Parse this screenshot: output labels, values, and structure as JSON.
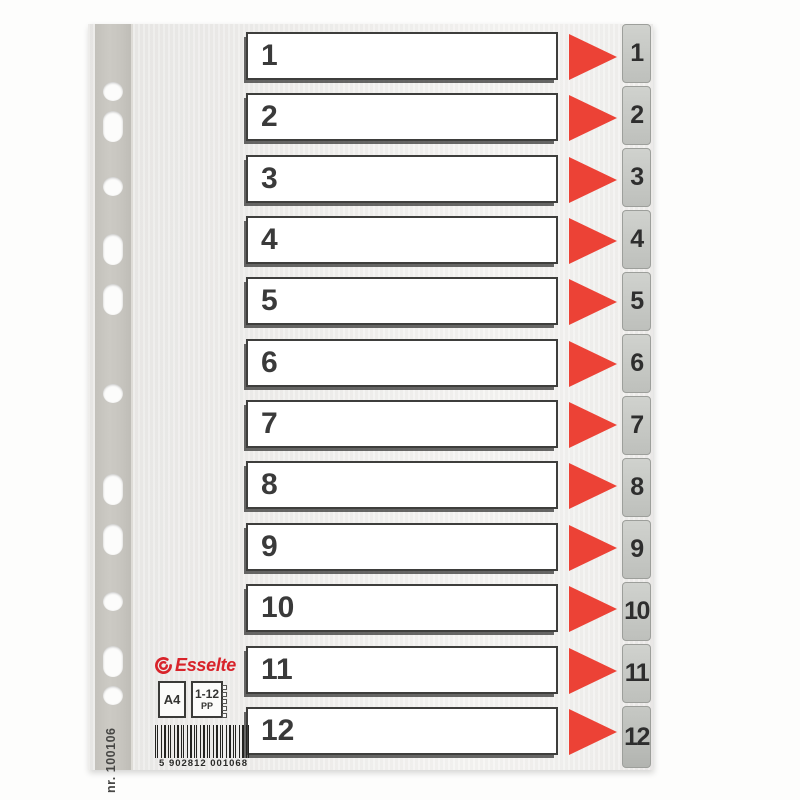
{
  "product": {
    "brand": "Esselte",
    "format": "A4",
    "index_range": "1-12",
    "material": "PP",
    "item_number": "nr. 100106",
    "barcode_digits": "5 902812 001068"
  },
  "rows": [
    {
      "label": "1"
    },
    {
      "label": "2"
    },
    {
      "label": "3"
    },
    {
      "label": "4"
    },
    {
      "label": "5"
    },
    {
      "label": "6"
    },
    {
      "label": "7"
    },
    {
      "label": "8"
    },
    {
      "label": "9"
    },
    {
      "label": "10"
    },
    {
      "label": "11"
    },
    {
      "label": "12"
    }
  ],
  "tabs": [
    {
      "label": "1"
    },
    {
      "label": "2"
    },
    {
      "label": "3"
    },
    {
      "label": "4"
    },
    {
      "label": "5"
    },
    {
      "label": "6"
    },
    {
      "label": "7"
    },
    {
      "label": "8"
    },
    {
      "label": "9"
    },
    {
      "label": "10"
    },
    {
      "label": "11"
    },
    {
      "label": "12"
    }
  ],
  "icons": {
    "row_arrow": "triangle-right",
    "brand_mark": "esselte-swoosh"
  },
  "colors": {
    "arrow_red": "#ec4236",
    "logo_red": "#d8232a",
    "tab_gray": "#c6c8c4",
    "binding_strip_gray": "#c8c6c0",
    "box_border": "#3e3e3c"
  }
}
